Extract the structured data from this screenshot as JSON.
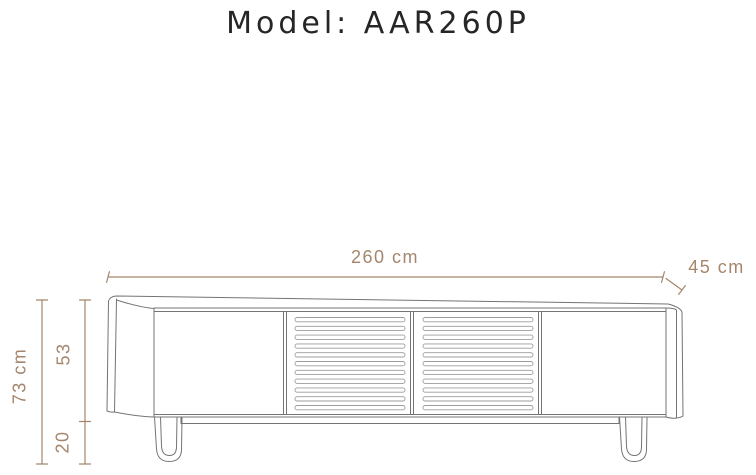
{
  "title": "Model: AAR260P",
  "colors": {
    "background": "#ffffff",
    "title_text": "#262626",
    "drawing_outline": "#747474",
    "slat_outline": "#9c9c9c",
    "dimension_annotations": "#a5866c"
  },
  "dimensions": {
    "width_label": "260 cm",
    "depth_label": "45 cm",
    "total_height_label": "73 cm",
    "cabinet_height_label": "53",
    "leg_height_label": "20"
  }
}
